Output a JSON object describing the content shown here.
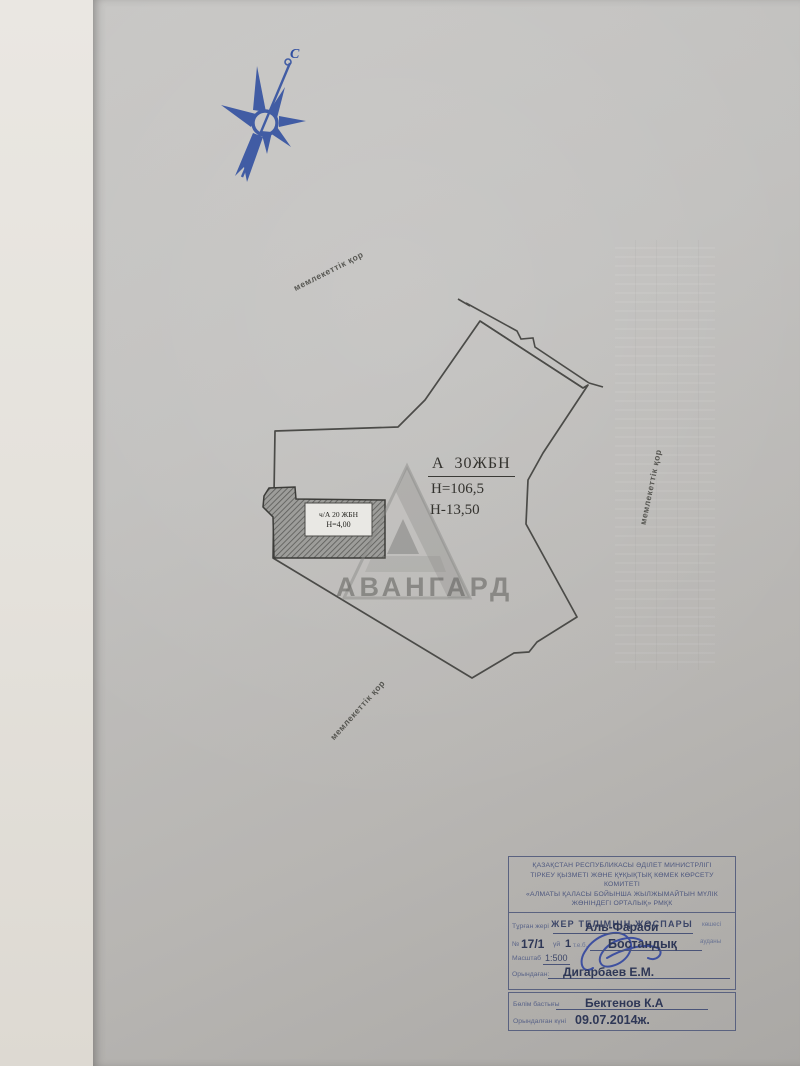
{
  "document": {
    "north_label": "С",
    "boundary_note_1": "мемлекеттік қор",
    "boundary_note_2": "мемлекеттік қор",
    "boundary_note_3": "мемлекеттік қор",
    "area_label": {
      "code": "А  30ЖБН",
      "height": "Н=106,5",
      "depth": "Н-13,50"
    },
    "building_label": {
      "code": "ч/А 20 ЖБН",
      "height": "Н=4,00"
    },
    "watermark": "АВАНГАРД"
  },
  "stamp": {
    "header_lines": [
      "ҚАЗАҚСТАН РЕСПУБЛИКАСЫ ӘДІЛЕТ МИНИСТРЛІГІ",
      "ТІРКЕУ ҚЫЗМЕТІ ЖӘНЕ ҚҰҚЫҚТЫҚ КӨМЕК КӨРСЕТУ КОМИТЕТІ",
      "«АЛМАТЫ ҚАЛАСЫ БОЙЫНША ЖЫЛЖЫМАЙТЫН МҮЛІК",
      "ЖӨНІНДЕГІ ОРТАЛЫҚ» РМҚК"
    ],
    "title": "ЖЕР ТЕЛІМНІҢ ЖОСПАРЫ",
    "location_label": "Тұрған жері",
    "location_value": "Аль-Фараби",
    "street_suffix": "көшесі",
    "number_label": "№",
    "number_value": "17/1",
    "house_label": "үй",
    "house_value": "1",
    "unit_label": "т.е.б.",
    "district_value": "Бостандық",
    "district_suffix": "ауданы",
    "scale_label": "Масштаб",
    "scale_value": "1:500",
    "executor_label": "Орындаған:",
    "executor_value": "Дигарбаев Е.М.",
    "head_label": "Бөлім бастығы",
    "head_value": "Бектенов К.А",
    "date_label": "Орындалған күні",
    "date_value": "09.07.2014ж."
  },
  "colors": {
    "drawing_ink": "#4b4b48",
    "stamp_ink": "#46507a",
    "compass_blue": "#2f4ea0",
    "signature_blue": "#2a3f9e",
    "paper": "#bcbab7"
  }
}
